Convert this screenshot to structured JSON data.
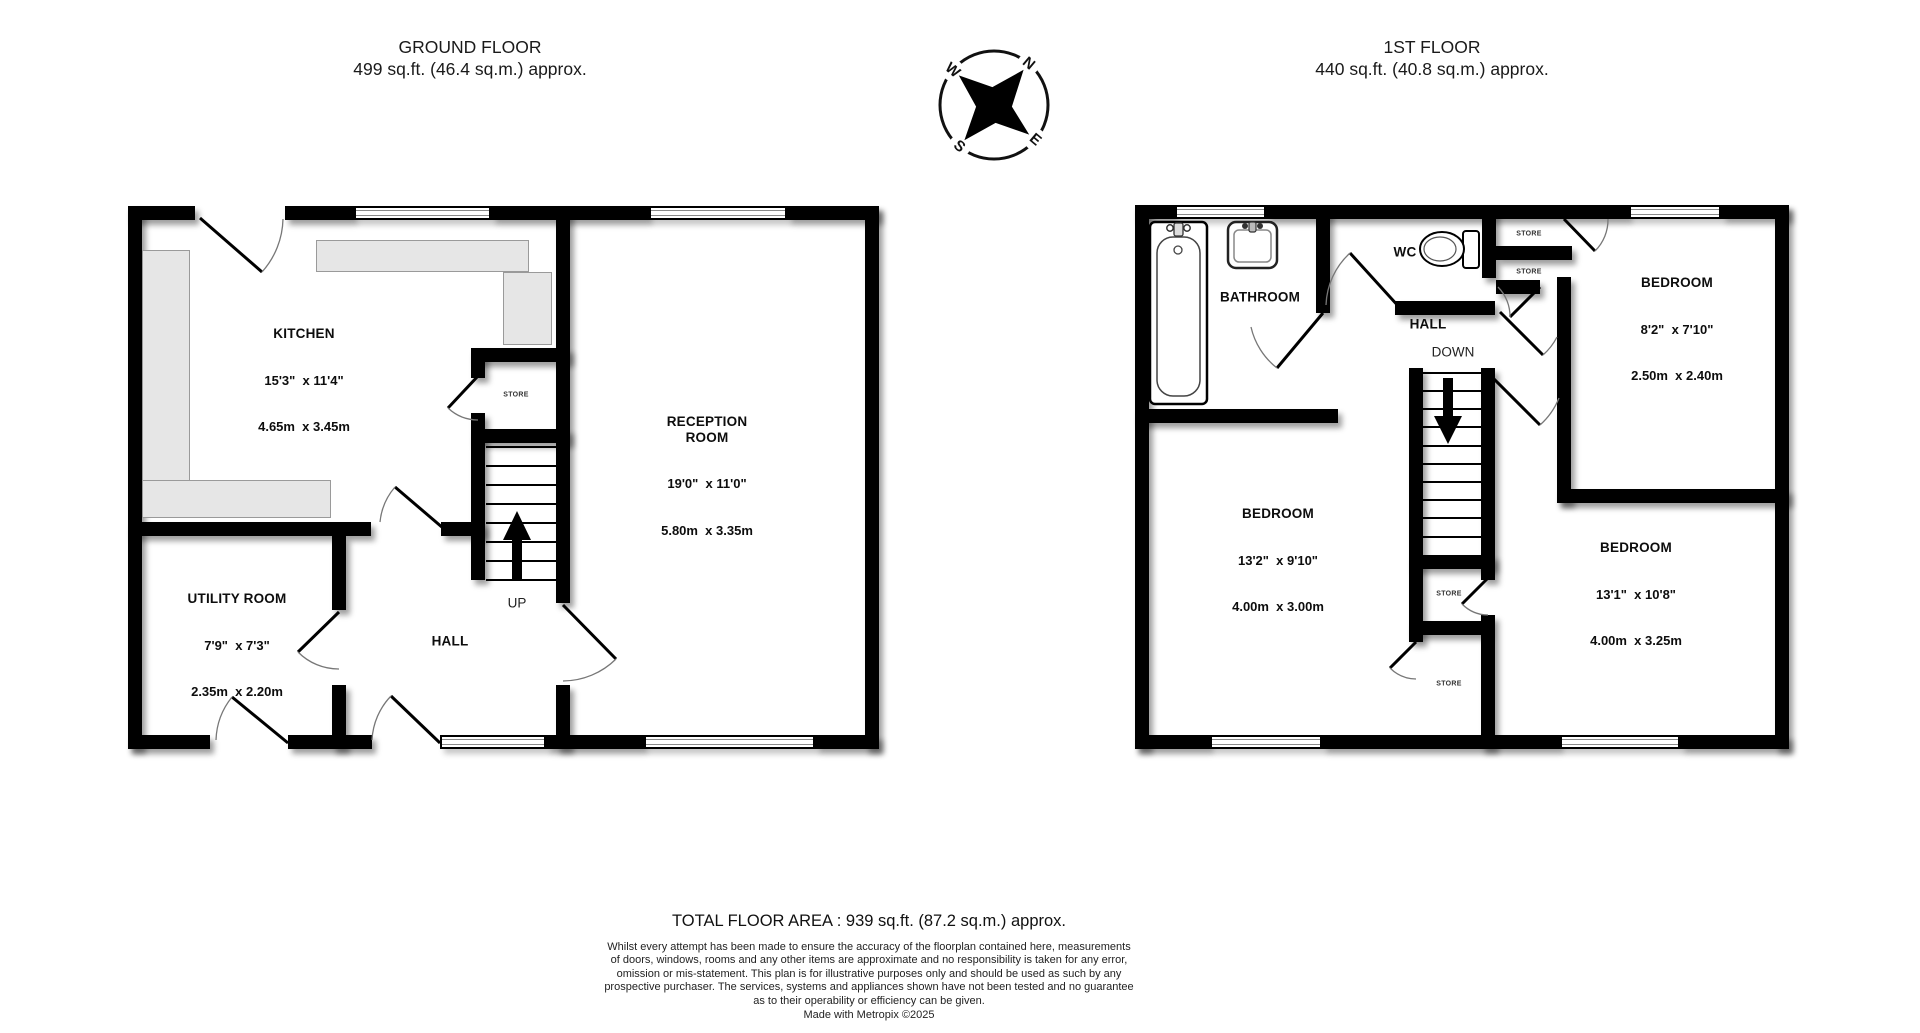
{
  "floors": [
    {
      "id": "ground",
      "title": "GROUND FLOOR",
      "subtitle": "499 sq.ft. (46.4 sq.m.) approx.",
      "rooms": [
        {
          "name": "KITCHEN",
          "dims": "15'3\"  x 11'4\"",
          "metric": "4.65m  x 3.45m"
        },
        {
          "name": "RECEPTION\nROOM",
          "dims": "19'0\"  x 11'0\"",
          "metric": "5.80m  x 3.35m"
        },
        {
          "name": "UTILITY ROOM",
          "dims": "7'9\"  x 7'3\"",
          "metric": "2.35m  x 2.20m"
        },
        {
          "name": "HALL"
        }
      ],
      "annotations": {
        "store": "STORE",
        "up": "UP"
      }
    },
    {
      "id": "first",
      "title": "1ST FLOOR",
      "subtitle": "440 sq.ft. (40.8 sq.m.) approx.",
      "rooms": [
        {
          "name": "BATHROOM"
        },
        {
          "name": "WC"
        },
        {
          "name": "HALL"
        },
        {
          "name": "BEDROOM",
          "dims": "8'2\"  x 7'10\"",
          "metric": "2.50m  x 2.40m"
        },
        {
          "name": "BEDROOM",
          "dims": "13'2\"  x 9'10\"",
          "metric": "4.00m  x 3.00m"
        },
        {
          "name": "BEDROOM",
          "dims": "13'1\"  x 10'8\"",
          "metric": "4.00m  x 3.25m"
        }
      ],
      "annotations": {
        "store": "STORE",
        "down": "DOWN"
      }
    }
  ],
  "compass": {
    "n": "N",
    "e": "E",
    "s": "S",
    "w": "W"
  },
  "footer": {
    "total": "TOTAL FLOOR AREA : 939 sq.ft. (87.2 sq.m.) approx.",
    "disclaimer_lines": [
      "Whilst every attempt has been made to ensure the accuracy of the floorplan contained here, measurements",
      "of doors, windows, rooms and any other items are approximate and no responsibility is taken for any error,",
      "omission or mis-statement. This plan is for illustrative purposes only and should be used as such by any",
      "prospective purchaser. The services, systems and appliances shown have not been tested and no guarantee",
      "as to their operability or efficiency can be given."
    ],
    "credit": "Made with Metropix ©2025"
  },
  "colors": {
    "wall": "#000000",
    "counter": "#e6e6e6",
    "window_line": "#8a8a8a"
  }
}
